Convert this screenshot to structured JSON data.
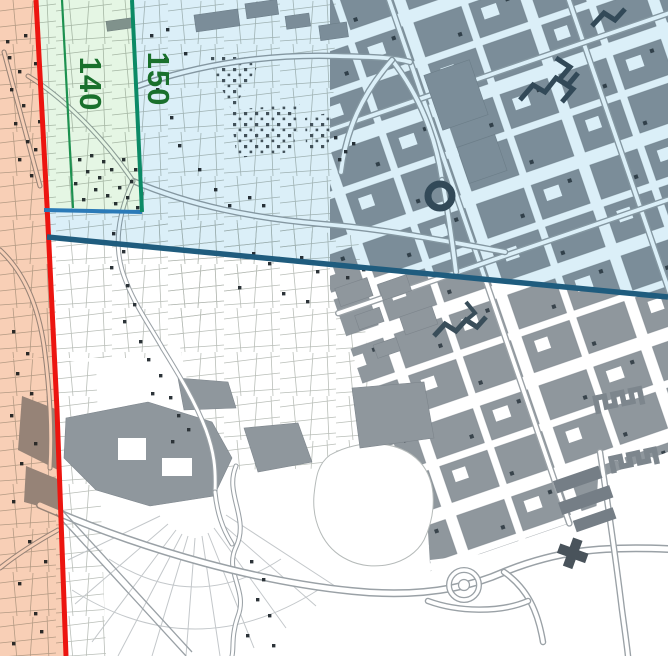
{
  "map": {
    "zone_labels": [
      {
        "id": "strip-140",
        "text": "140"
      },
      {
        "id": "outer-150",
        "text": "150"
      }
    ],
    "colors": {
      "zone_left_overlay": "#f6c5a6",
      "zone_upper_overlay": "#d3ecf7",
      "zone_strip_overlay": "#dff4de",
      "boundary_red": "#ec1510",
      "boundary_navy": "#1f5c7e",
      "boundary_teal": "#0c8a66",
      "divider_green": "#1d9150",
      "edge_blue": "#2b7ab8",
      "label_green": "#19702c",
      "building_gray": "#8f979d",
      "building_dark": "#3a4e5a",
      "road_casing": "#9aa1a6"
    }
  }
}
